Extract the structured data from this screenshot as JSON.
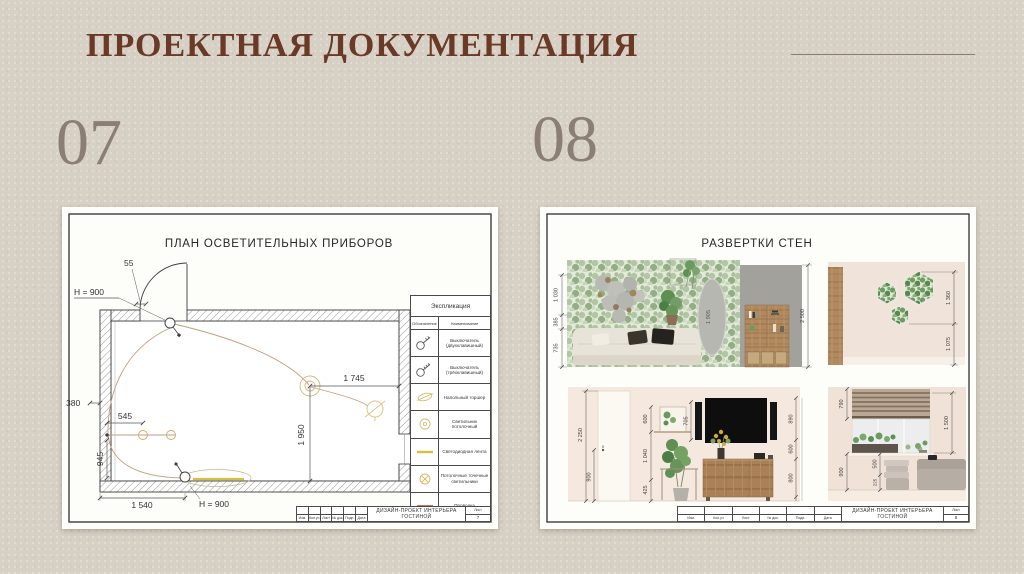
{
  "slide": {
    "title": "ПРОЕКТНАЯ ДОКУМЕНТАЦИЯ"
  },
  "colors": {
    "background": "#d7d1c5",
    "title_brown": "#6b3927",
    "number_gray": "#8b7e74",
    "wiring_arc": "#c79b80",
    "lamp_yellow": "#d3b878",
    "led_yellow": "#d4c23e",
    "wiring_legend_red": "#b2563a",
    "foliage_green": "#93ad85",
    "wood_brown": "#b08a5e"
  },
  "stamp": {
    "columns": [
      "Изм.",
      "Кол.уч",
      "Лист",
      "№ док.",
      "Подп.",
      "Дата"
    ],
    "project": "ДИЗАЙН-ПРОЕКТ ИНТЕРЬЕРА ГОСТИНОЙ",
    "sheet_word": "Лист"
  },
  "plan07": {
    "number": "07",
    "sheet_title": "ПЛАН ОСВЕТИТЕЛЬНЫХ ПРИБОРОВ",
    "sheet_no": "7",
    "dims": {
      "door_gap": "55",
      "switch_height_top": "H = 900",
      "wall_380": "380",
      "spots_545": "545",
      "left_945": "945",
      "bottom_1540": "1 540",
      "switch_height_bottom": "H = 900",
      "light_1745": "1 745",
      "light_1950": "1 950"
    },
    "legend": {
      "title": "Экспликация",
      "col_symbol": "Обозначение",
      "col_name": "Наименование",
      "rows": [
        {
          "icon": "switch-2gang-icon",
          "label": "Выключатель (двухклавишный)"
        },
        {
          "icon": "switch-3gang-icon",
          "label": "Выключатель (трёхклавишный)"
        },
        {
          "icon": "floor-lamp-icon",
          "label": "Напольный торшер"
        },
        {
          "icon": "ceiling-light-icon",
          "label": "Светильник потолочный"
        },
        {
          "icon": "led-strip-icon",
          "label": "Светодиодная лента"
        },
        {
          "icon": "spot-lights-icon",
          "label": "Потолочные точечные светильники"
        },
        {
          "icon": "wiring-icon",
          "label": "Проводка"
        }
      ]
    }
  },
  "plan08": {
    "number": "08",
    "sheet_title": "РАЗВЕРТКИ СТЕН",
    "sheet_no": "8",
    "elevations": {
      "living_wall": {
        "dims": [
          "1 030",
          "385",
          "735",
          "1 905",
          "2 500"
        ]
      },
      "hex_wall": {
        "dims": [
          "1 360",
          "1 075"
        ]
      },
      "tv_wall": {
        "dims": [
          "2 250",
          "900",
          "600",
          "1 040",
          "425",
          "705",
          "890",
          "600",
          "800"
        ]
      },
      "window_wall": {
        "dims": [
          "790",
          "1 500",
          "900",
          "500",
          "225"
        ]
      }
    }
  }
}
